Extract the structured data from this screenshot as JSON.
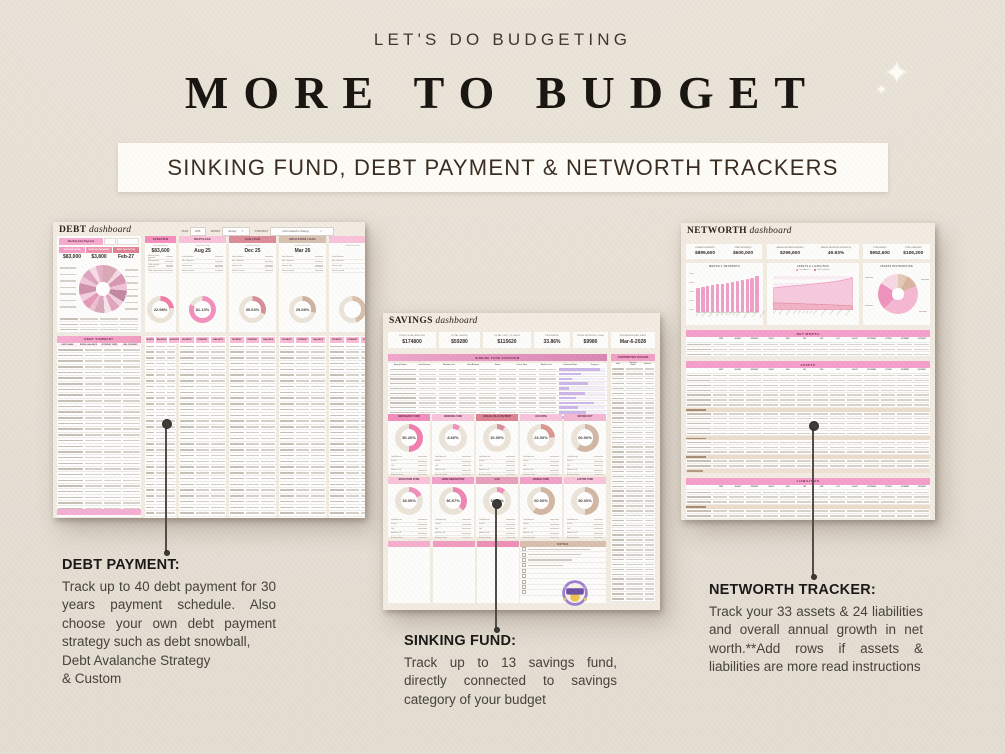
{
  "page": {
    "eyebrow": "LET'S DO BUDGETING",
    "title": "MORE TO BUDGET",
    "banner": "SINKING FUND, DEBT PAYMENT & NETWORTH TRACKERS",
    "sparkle": "✦"
  },
  "annotations": {
    "debt": {
      "heading": "DEBT PAYMENT:",
      "body": "Track up to 40 debt payment for 30 years payment schedule. Also choose your own debt payment strategy such as debt snowball,",
      "tail1": "Debt Avalanche Strategy",
      "tail2": "& Custom"
    },
    "sinking": {
      "heading": "SINKING FUND:",
      "body": "Track up to 13 savings fund, directly connected to savings category of your budget"
    },
    "networth": {
      "heading": "NETWORTH TRACKER:",
      "body": "Track your 33 assets & 24 liabilities and overall annual growth in net worth.**Add rows if assets & liabilities are more read instructions"
    }
  },
  "debt": {
    "title": "DEBT",
    "title_word": "dashboard",
    "controls": [
      {
        "label": "YEAR",
        "value": "2025"
      },
      {
        "label": "MONTH",
        "value": "January"
      },
      {
        "label": "STRATEGY",
        "value": "Debt Avalanche Strategy"
      }
    ],
    "extra_payment_label": "Monthly Extra Payment",
    "stats": [
      {
        "label": "TOTAL BALANCE",
        "value": "$83,000",
        "color": "#f2a0c5"
      },
      {
        "label": "MONTHLY PAYMENTS",
        "value": "$3,800",
        "color": "#ec93ab"
      },
      {
        "label": "DEBT PAID OFF BY",
        "value": "Feb-27",
        "color": "#df8194"
      }
    ],
    "donut_segments": [
      {
        "pct": 10,
        "color": "#d9a8b6"
      },
      {
        "pct": 4,
        "color": "#f6d9e5"
      },
      {
        "pct": 7,
        "color": "#d797b2"
      },
      {
        "pct": 5,
        "color": "#f2c3d6"
      },
      {
        "pct": 8,
        "color": "#c387a3"
      },
      {
        "pct": 4,
        "color": "#f0d0dd"
      },
      {
        "pct": 6,
        "color": "#e3a4bd"
      },
      {
        "pct": 5,
        "color": "#f7e3ea"
      },
      {
        "pct": 7,
        "color": "#d8a8ba"
      },
      {
        "pct": 4,
        "color": "#eec0d2"
      },
      {
        "pct": 6,
        "color": "#e59ab8"
      },
      {
        "pct": 5,
        "color": "#f3cfe0"
      },
      {
        "pct": 8,
        "color": "#cf93ab"
      },
      {
        "pct": 5,
        "color": "#f0c8d8"
      },
      {
        "pct": 6,
        "color": "#dda4c0"
      },
      {
        "pct": 5,
        "color": "#f6dce7"
      },
      {
        "pct": 5,
        "color": "#e6afc6"
      }
    ],
    "cards": [
      {
        "header": "OVERVIEW",
        "header_color": "#f48fbd",
        "label": "Current Balance",
        "value": "$83,600",
        "rows": [
          "Monthly extra payment",
          "Min payment",
          "Total monthly payment",
          "Total interest saved"
        ],
        "percent": "22.98%",
        "pct": 22.98,
        "ring": "#f17ca8"
      },
      {
        "header": "MORTGAGE",
        "header_color": "#f9c3da",
        "label": "Debt Free Date",
        "value": "Aug 25",
        "rows": [
          "Initial balance",
          "Min. Payment",
          "Interest rate",
          "Interest saved"
        ],
        "percent": "81.13%",
        "pct": 81.13,
        "ring": "#f48fbd"
      },
      {
        "header": "CAR LOAN",
        "header_color": "#db8c98",
        "label": "Debt Free Date",
        "value": "Dec 25",
        "rows": [
          "Initial balance",
          "Min. Payment",
          "Interest rate",
          "Interest saved"
        ],
        "percent": "30.63%",
        "pct": 30.63,
        "ring": "#d68e9a"
      },
      {
        "header": "EDUCATION LOAN",
        "header_color": "#d7c1b0",
        "label": "Debt Free Date",
        "value": "Mar 26",
        "rows": [
          "Initial balance",
          "Min. Payment",
          "Interest rate",
          "Interest saved"
        ],
        "percent": "29.08%",
        "pct": 29.08,
        "ring": "#cdb39f"
      },
      {
        "header": "",
        "header_color": "#f9c3da",
        "label": "Debt Free Date",
        "value": "",
        "rows": [
          "Initial balance",
          "Min. Payment",
          "Interest rate",
          "Interest saved"
        ],
        "percent": "",
        "pct": 45,
        "ring": "#d8bfaa"
      }
    ],
    "summary_title": "DEBT SUMMARY",
    "summary_columns": [
      "DEBT NAME",
      "INITIAL BALANCE",
      "INTEREST RATE",
      "MIN. PAYMENT"
    ],
    "schedule_columns": [
      "MONTH",
      "BALANCE",
      "ADJUSTMENT"
    ],
    "payment_columns": [
      "PAYMENT",
      "INTEREST",
      "BALANCE"
    ]
  },
  "savings": {
    "title": "SAVINGS",
    "title_word": "dashboard",
    "stats": [
      {
        "label": "TOTAL GOAL AMOUNT",
        "value": "$174800"
      },
      {
        "label": "TOTAL SAVED",
        "value": "$59280"
      },
      {
        "label": "TOTAL LEFT TO SAVE",
        "value": "$115620"
      },
      {
        "label": "PROGRESS",
        "value": "33.86%"
      },
      {
        "label": "TOTAL MONTHLY GOAL",
        "value": "$9980"
      },
      {
        "label": "ESTIMATED END DATE",
        "value": "Mar-6-2028"
      }
    ],
    "overview_banner": "SINKING FUND OVERVIEW",
    "tracker_banner": "CONTRIBUTION TRACKER",
    "overview_columns": [
      "Savings Name",
      "Goal Amount",
      "Monthly Goal",
      "Start Balance",
      "Saved",
      "Left to Save",
      "Months Left",
      "Estimated Date",
      "Progress"
    ],
    "tracker_columns": [
      "Date",
      "Savings Name",
      "Amount"
    ],
    "progress_bars": [
      88,
      46,
      28,
      62,
      20,
      55,
      35,
      75,
      40,
      58,
      30
    ],
    "cards": [
      {
        "header": "EMERGENCY FUND",
        "header_color": "#f28fbc",
        "percent": "50.20%",
        "pct": 50.2,
        "ring": "#f180ae"
      },
      {
        "header": "WEDDING FUND",
        "header_color": "#f9c4da",
        "percent": "8.60%",
        "pct": 8.6,
        "ring": "#f28fbc"
      },
      {
        "header": "ANNUAL BILLS PAYMENT",
        "header_color": "#dd8494",
        "percent": "10.00%",
        "pct": 10,
        "ring": "#d98f9b"
      },
      {
        "header": "VACATION",
        "header_color": "#f9c4da",
        "percent": "24.00%",
        "pct": 24,
        "ring": "#d9988f"
      },
      {
        "header": "MOVING OUT",
        "header_color": "#f3b7d2",
        "percent": "60.00%",
        "pct": 60,
        "ring": "#d2b8a3"
      },
      {
        "header": "EDUCATION FUND",
        "header_color": "#f9c4da",
        "percent": "18.00%",
        "pct": 18,
        "ring": "#f28fbc"
      },
      {
        "header": "HOME RENOVATION",
        "header_color": "#f2a1c8",
        "percent": "36.67%",
        "pct": 36.67,
        "ring": "#ef86b4"
      },
      {
        "header": "CAR",
        "header_color": "#e8a0bd",
        "percent": "10.00%",
        "pct": 10,
        "ring": "#f28fbc"
      },
      {
        "header": "MOBILE FUND",
        "header_color": "#f2a1c8",
        "percent": "60.00%",
        "pct": 60,
        "ring": "#d2b8a3"
      },
      {
        "header": "LAPTOP FUND",
        "header_color": "#f9c4da",
        "percent": "50.00%",
        "pct": 50,
        "ring": "#d2b8a3"
      }
    ],
    "card_rows": [
      "Goal Amount",
      "Saved",
      "Left",
      "Months Left",
      "Estimate Date"
    ],
    "notes_title": "NOTES"
  },
  "networth": {
    "title": "NETWORTH",
    "title_word": "dashboard",
    "stats": [
      {
        "label": "CURRENT NETWORTH",
        "value": "$899,600"
      },
      {
        "label": "START NETWORTH",
        "value": "$600,000"
      },
      {
        "label": "ANNUAL NETWORTH GROWTH",
        "value": "$299,600"
      },
      {
        "label": "ANNUAL NETWORTH GROWTH (%)",
        "value": "49.93%"
      },
      {
        "label": "TOTAL ASSETS",
        "value": "$952,600"
      },
      {
        "label": "TOTAL LIABILITIES",
        "value": "$106,200"
      }
    ],
    "months": [
      "START",
      "JANUARY",
      "FEBRUARY",
      "MARCH",
      "APRIL",
      "MAY",
      "JUNE",
      "JULY",
      "AUGUST",
      "SEPTEMBER",
      "OCTOBER",
      "NOVEMBER",
      "DECEMBER"
    ],
    "charts": {
      "bar": {
        "title": "MONTHLY NETWORTH",
        "max": 1000,
        "color": "#f09fc6",
        "values": [
          600,
          622,
          645,
          668,
          690,
          712,
          735,
          758,
          780,
          802,
          825,
          858,
          900
        ]
      },
      "area": {
        "title": "ASSETS & LIABILITIES",
        "max": 1000,
        "legend": [
          "Total Assets",
          "Total Liabilities"
        ],
        "legend_colors": [
          "#f07fb0",
          "#e2596f"
        ],
        "assets": [
          650,
          670,
          690,
          710,
          725,
          745,
          765,
          785,
          805,
          830,
          860,
          900,
          950
        ],
        "liabilities": [
          210,
          205,
          200,
          195,
          190,
          180,
          175,
          168,
          160,
          150,
          140,
          130,
          120
        ]
      },
      "donut": {
        "title": "ASSETS DISTRIBUTION",
        "segments": [
          {
            "pct": 8,
            "color": "#e3c9b8"
          },
          {
            "pct": 10,
            "color": "#d9b4a0"
          },
          {
            "pct": 44,
            "color": "#f5b8d3"
          },
          {
            "pct": 22,
            "color": "#ef93bc"
          },
          {
            "pct": 16,
            "color": "#f8d8e6"
          }
        ]
      }
    },
    "networth_banner": "NET WORTH",
    "assets_banner": "ASSETS",
    "liabilities_banner": "LIABILITIES"
  }
}
